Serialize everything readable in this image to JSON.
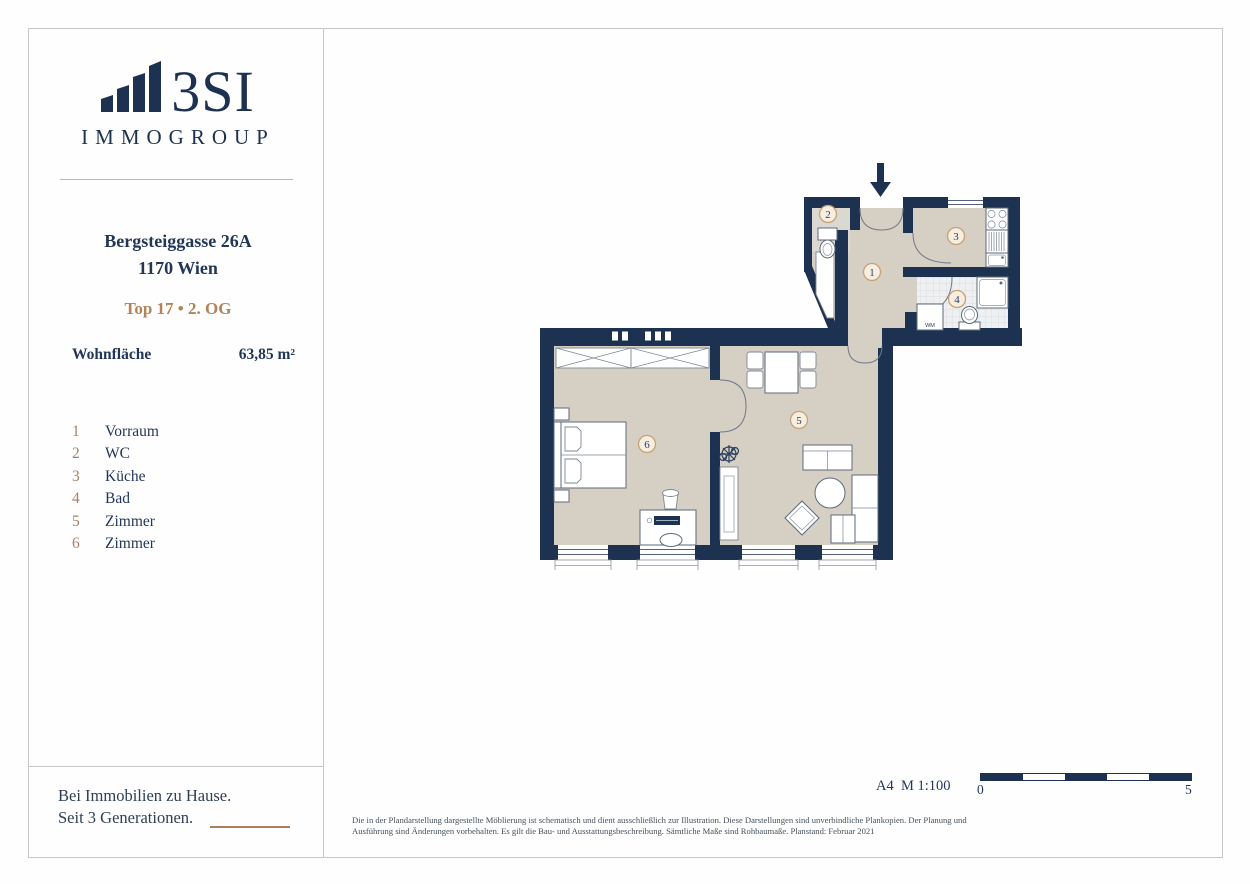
{
  "sidebar": {
    "logo": {
      "text": "3SI",
      "subtext": "IMMOGROUP"
    },
    "address_line1": "Bergsteiggasse 26A",
    "address_line2": "1170 Wien",
    "unit": "Top 17 • 2. OG",
    "area_label": "Wohnfläche",
    "area_value": "63,85 m²",
    "legend": [
      {
        "num": "1",
        "label": "Vorraum"
      },
      {
        "num": "2",
        "label": "WC"
      },
      {
        "num": "3",
        "label": "Küche"
      },
      {
        "num": "4",
        "label": "Bad"
      },
      {
        "num": "5",
        "label": "Zimmer"
      },
      {
        "num": "6",
        "label": "Zimmer"
      }
    ],
    "tagline_line1": "Bei Immobilien zu Hause.",
    "tagline_line2": "Seit 3 Generationen."
  },
  "plan": {
    "wm_label": "WM",
    "colors": {
      "wall": "#1d3150",
      "floor": "#d6cfc4",
      "accent": "#c9a174",
      "brand_navy": "#1d3150",
      "accent_tan": "#b28457"
    }
  },
  "footer": {
    "scale_label": "A4  M 1:100",
    "scale_start": "0",
    "scale_end": "5",
    "disclaimer": "Die in der Plandarstellung dargestellte Möblierung ist schematisch und dient ausschließlich zur Illustration. Diese Darstellungen sind unverbindliche Plankopien. Der Planung und Ausführung sind Änderungen vorbehalten. Es gilt die Bau- und Ausstattungsbeschreibung. Sämtliche Maße sind Rohbaumaße. Planstand: Februar 2021"
  }
}
